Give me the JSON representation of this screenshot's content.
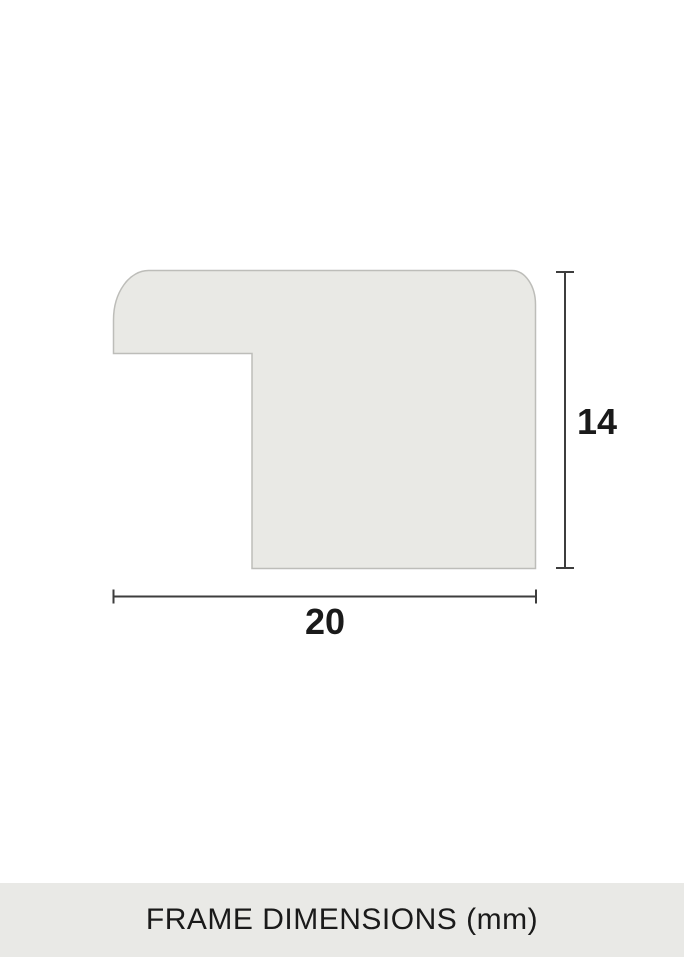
{
  "diagram": {
    "height_value": "14",
    "width_value": "20"
  },
  "footer": {
    "caption": "FRAME DIMENSIONS (mm)"
  },
  "colors": {
    "page_bg": "#ffffff",
    "shape_fill": "#e9e9e5",
    "shape_stroke": "#bdbdb9",
    "dimension_line": "#3d3d3d",
    "label_text": "#1a1a1a",
    "footer_bg": "#e9e9e6"
  }
}
